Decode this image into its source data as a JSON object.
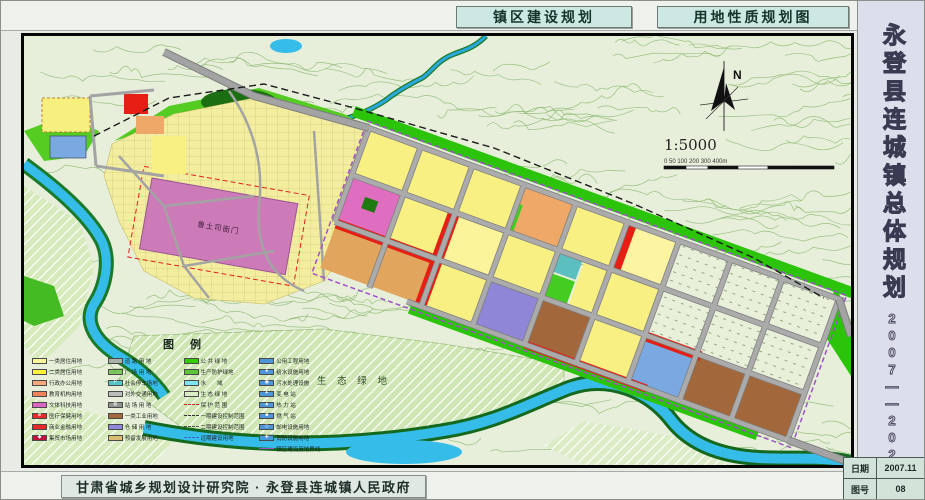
{
  "header": {
    "title_left": "镇区建设规划",
    "title_right": "用地性质规划图"
  },
  "sidebar": {
    "title": "永登县连城镇总体规划",
    "years": "2007——2020"
  },
  "footer": {
    "credit": "甘肃省城乡规划设计研究院 · 永登县连城镇人民政府"
  },
  "info": {
    "date_label": "日期",
    "date_value": "2007.11",
    "sheet_label": "图号",
    "sheet_value": "08"
  },
  "map": {
    "north_label": "N",
    "scale_text": "1:5000",
    "scale_ticks": "0  50 100     200     300     400m",
    "labels": {
      "historic_site": "鲁土司衙门",
      "eco_green": "生 态 绿 地"
    }
  },
  "legend": {
    "title": "图例",
    "columns": [
      [
        {
          "label": "一类居住用地",
          "swatch": {
            "kind": "fill",
            "color": "#fdf89a"
          }
        },
        {
          "label": "二类居住用地",
          "swatch": {
            "kind": "fill",
            "color": "#fbef3f"
          }
        },
        {
          "label": "行政办公用地",
          "swatch": {
            "kind": "fill",
            "color": "#f4a87c"
          }
        },
        {
          "label": "教育机构用地",
          "swatch": {
            "kind": "fill",
            "color": "#ee8258"
          }
        },
        {
          "label": "文体科技用地",
          "swatch": {
            "kind": "fill",
            "color": "#d966c2"
          }
        },
        {
          "label": "医疗保健用地",
          "swatch": {
            "kind": "fill",
            "color": "#e62a28",
            "symbol": "⊕",
            "symbolColor": "#ffffff"
          }
        },
        {
          "label": "商业金融用地",
          "swatch": {
            "kind": "fill",
            "color": "#e62a28"
          }
        },
        {
          "label": "集贸市场用地",
          "swatch": {
            "kind": "fill",
            "color": "#bf1440",
            "symbol": "◆",
            "symbolColor": "#ffffff"
          }
        }
      ],
      [
        {
          "label": "道 路 用 地",
          "swatch": {
            "kind": "fill",
            "color": "#a9afa9"
          }
        },
        {
          "label": "广 场 用 地",
          "swatch": {
            "kind": "fill",
            "color": "#7cc75e",
            "symbol": "∷",
            "symbolColor": "#2a6a22"
          }
        },
        {
          "label": "社会停车场地",
          "swatch": {
            "kind": "fill",
            "color": "#57c6c6",
            "symbol": "P",
            "symbolColor": "#ffffff"
          }
        },
        {
          "label": "对外交通用地",
          "swatch": {
            "kind": "fill",
            "color": "#b9bdb9"
          }
        },
        {
          "label": "站 场 用 地",
          "swatch": {
            "kind": "fill",
            "color": "#8e948e",
            "symbol": "◍",
            "symbolColor": "#ffffff"
          }
        },
        {
          "label": "一类工业用地",
          "swatch": {
            "kind": "fill",
            "color": "#a2683c"
          }
        },
        {
          "label": "仓 储 用 地",
          "swatch": {
            "kind": "fill",
            "color": "#8f86d8"
          }
        },
        {
          "label": "预留发展用地",
          "swatch": {
            "kind": "fill",
            "color": "#d9bd72"
          }
        }
      ],
      [
        {
          "label": "公 共 绿 地",
          "swatch": {
            "kind": "fill",
            "color": "#33cc00"
          }
        },
        {
          "label": "生产防护绿地",
          "swatch": {
            "kind": "fill",
            "color": "#5ec437"
          }
        },
        {
          "label": "水　　域",
          "swatch": {
            "kind": "fill",
            "color": "#7fe3f0"
          }
        },
        {
          "label": "生 态 绿 地",
          "swatch": {
            "kind": "hatch",
            "color": "#d9ecc4"
          }
        },
        {
          "label": "保 护 范 围",
          "swatch": {
            "kind": "line",
            "color": "#e02020",
            "style": "dashed"
          }
        },
        {
          "label": "一期建设控制范围",
          "swatch": {
            "kind": "line",
            "color": "#333333",
            "style": "dashed"
          }
        },
        {
          "label": "二期建设控制范围",
          "swatch": {
            "kind": "line",
            "color": "#555555",
            "style": "dashed"
          }
        },
        {
          "label": "远期建设用地",
          "swatch": {
            "kind": "line",
            "color": "#3a6ad0",
            "style": "dashed"
          }
        }
      ],
      [
        {
          "label": "公用工程用地",
          "swatch": {
            "kind": "fill",
            "color": "#4d96d9"
          }
        },
        {
          "label": "给水设施用地",
          "swatch": {
            "kind": "fill",
            "color": "#4d96d9",
            "symbol": "●",
            "symbolColor": "#ffffff"
          }
        },
        {
          "label": "污水处理设施",
          "swatch": {
            "kind": "fill",
            "color": "#4d96d9",
            "symbol": "◉",
            "symbolColor": "#ffffff"
          }
        },
        {
          "label": "变 电 站",
          "swatch": {
            "kind": "fill",
            "color": "#4d96d9",
            "symbol": "✦",
            "symbolColor": "#ffffff"
          }
        },
        {
          "label": "热 力 站",
          "swatch": {
            "kind": "fill",
            "color": "#4d96d9",
            "symbol": "▲",
            "symbolColor": "#ffffff"
          }
        },
        {
          "label": "燃 气 站",
          "swatch": {
            "kind": "fill",
            "color": "#4d96d9",
            "symbol": "■",
            "symbolColor": "#ffffff"
          }
        },
        {
          "label": "邮电设施用地",
          "swatch": {
            "kind": "fill",
            "color": "#4d96d9",
            "symbol": "◇",
            "symbolColor": "#ffffff"
          }
        },
        {
          "label": "消防设施用地",
          "swatch": {
            "kind": "fill",
            "color": "#4d96d9",
            "symbol": "✚",
            "symbolColor": "#ffffff"
          }
        },
        {
          "label": "镇区建设用地界线",
          "swatch": {
            "kind": "line",
            "color": "#a050c8",
            "style": "solid"
          }
        }
      ]
    ]
  },
  "colors": {
    "residential_yellow": "#f7ef7d",
    "commercial_red": "#e61e14",
    "industrial_brown": "#a2683c",
    "green_space": "#2cc40a",
    "water_cyan": "#35bce8",
    "road_gray": "#a3a3a3",
    "historic_pink": "#cc7ab8"
  }
}
